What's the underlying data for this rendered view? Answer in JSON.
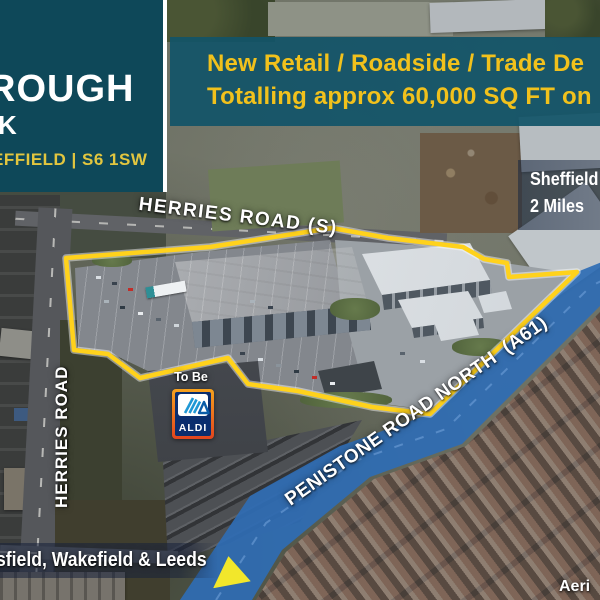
{
  "panel": {
    "title_fragment": "ROUGH",
    "subtitle_fragment": "K",
    "address_fragment": "EFFIELD | S6 1SW"
  },
  "banner": {
    "line1": "New Retail / Roadside / Trade De",
    "line2": "Totalling approx 60,000 SQ FT on"
  },
  "map": {
    "distance_badge": {
      "line1": "Sheffield",
      "line2": "2 Miles"
    },
    "roads": {
      "top": "HERRIES ROAD (S)",
      "left": "HERRIES ROAD",
      "main": "PENISTONE ROAD NORTH  (A61)"
    },
    "destinations_fragment": "sfield, Wakefield & Leeds",
    "caption_fragment": "Aeri"
  },
  "aldi_sign": {
    "status": "To Be",
    "brand": "ALDI"
  },
  "colors": {
    "panel_teal": "#0E4859",
    "banner_teal": "#125468",
    "headline_gold": "#F1C11C",
    "panel_gold": "#E2C63F",
    "boundary_yellow": "#FFD21C",
    "road_overlay_blue": "#2F6DB4",
    "arrow_yellow": "#F2E72B",
    "aldi_navy": "#0A2D6E",
    "aldi_orange": "#F07E1E",
    "aldi_cyan": "#2BB3E6",
    "label_white": "#FFFFFF"
  }
}
